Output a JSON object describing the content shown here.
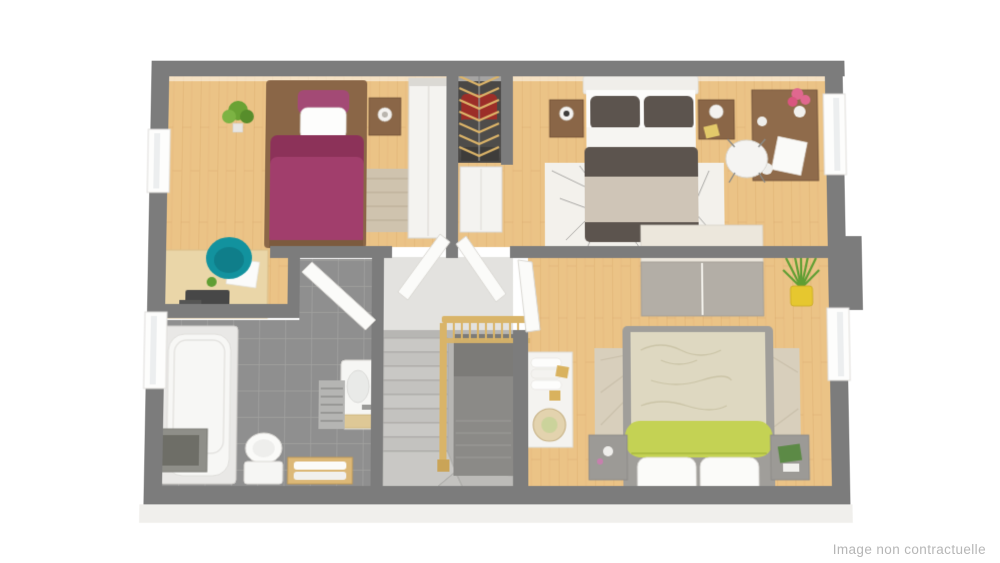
{
  "watermark": "Image non contractuelle",
  "colors": {
    "wall": "#7c7c7c",
    "wall_dark": "#6f6f6f",
    "floor_wood": "#ebc386",
    "floor_wood_dark": "#d29e5e",
    "floor_tile": "#8f8f8f",
    "tile_grout": "#a3a3a1",
    "hall_floor": "#e3e2df",
    "closet_dark": "#4a4846",
    "stair_tread": "#c9c8c5",
    "stair_well": "#8b8a87",
    "railing": "#d9b468",
    "bed1_purple": "#a13e6c",
    "bed1_purple_dark": "#8c3259",
    "wood_furniture": "#8a6647",
    "desk_wood": "#ead6a8",
    "chair_teal": "#12929e",
    "master_dark": "#5c544e",
    "master_beige": "#cfc5b7",
    "rug_beige": "#cfc3ae",
    "rug_beige2": "#d8cfbc",
    "rug_white": "#f3f1ec",
    "bed3_cream": "#ded8c1",
    "bed3_green": "#c4d254",
    "white_furniture": "#f4f3f0",
    "plant_green": "#5f9e33",
    "pot_yellow": "#e6c72f",
    "flower_pink": "#e0688f",
    "hanger_tan": "#dcb469",
    "clothes_red": "#9c2e28",
    "clothes_dark": "#4e4c4a",
    "slab": "#f0efec",
    "watermark": "#b6b6b6"
  }
}
